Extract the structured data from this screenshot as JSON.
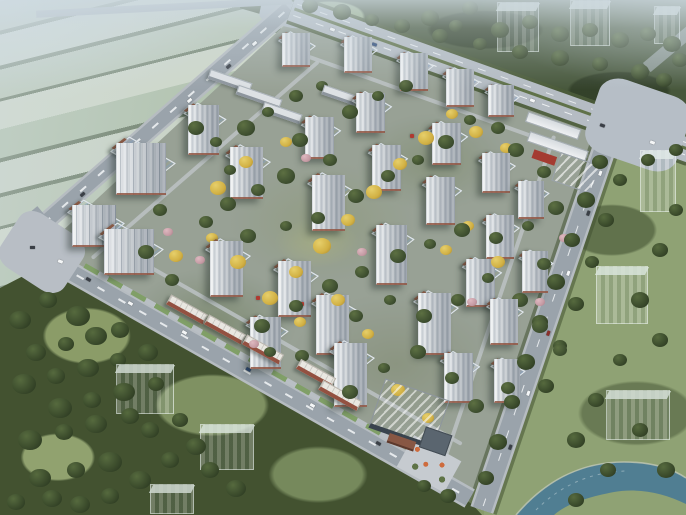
{
  "scene": {
    "type": "aerial-architectural-rendering",
    "subject": "residential-masterplan-birdseye",
    "width": 686,
    "height": 515
  },
  "palette": {
    "farm_light": "#c6d0bd",
    "farm_mid": "#b2c2a9",
    "hedge": "#5d7053",
    "forest": "#46573a",
    "park": "#42522f",
    "lawn": "#8a9c66",
    "east_lawn": "#8ea272",
    "asphalt": "#9aa3ab",
    "arterial": "#b5bcc3",
    "lane_line": "#eef1f3",
    "median_green": "#5f7247",
    "plaza": "#b8bec5",
    "site_ground": "#98a195",
    "tower_roof_navy": "#2c3e54",
    "tower_facade": "#eceff1",
    "tower_shade": "#aab3bc",
    "roof_trim_brown": "#8a5a45",
    "brick_retail": "#96503f",
    "retail_roof": "#e9e7e1",
    "school_white": "#eef0f2",
    "school_red": "#a83a2f",
    "water": "#4e7e93",
    "ghost_building": "rgba(190,206,201,0.55)",
    "gold_tree": "#d4b13e",
    "pink_tree": "#c79aa4",
    "accent_red": "#b5382e",
    "haze": "#cfdbe3"
  },
  "buildings": {
    "towers": [
      [
        282,
        36,
        30,
        34
      ],
      [
        344,
        40,
        30,
        36
      ],
      [
        400,
        56,
        30,
        38
      ],
      [
        446,
        72,
        30,
        38
      ],
      [
        488,
        88,
        28,
        32
      ],
      [
        305,
        120,
        32,
        42
      ],
      [
        356,
        96,
        32,
        40
      ],
      [
        432,
        126,
        32,
        42
      ],
      [
        482,
        156,
        30,
        40
      ],
      [
        518,
        184,
        28,
        38
      ],
      [
        188,
        108,
        34,
        50
      ],
      [
        230,
        150,
        36,
        52
      ],
      [
        312,
        178,
        36,
        56
      ],
      [
        372,
        148,
        32,
        46
      ],
      [
        426,
        180,
        32,
        48
      ],
      [
        486,
        218,
        30,
        44
      ],
      [
        72,
        208,
        48,
        42
      ],
      [
        116,
        146,
        54,
        52
      ],
      [
        104,
        232,
        54,
        46
      ],
      [
        210,
        244,
        36,
        56
      ],
      [
        278,
        264,
        36,
        56
      ],
      [
        376,
        228,
        34,
        60
      ],
      [
        466,
        262,
        32,
        48
      ],
      [
        522,
        254,
        28,
        42
      ],
      [
        250,
        320,
        34,
        52
      ],
      [
        316,
        298,
        36,
        60
      ],
      [
        418,
        296,
        36,
        62
      ],
      [
        490,
        302,
        30,
        46
      ],
      [
        494,
        362,
        28,
        44
      ],
      [
        334,
        346,
        36,
        64
      ],
      [
        444,
        356,
        32,
        50
      ]
    ],
    "ghosts": [
      [
        497,
        2,
        42,
        50
      ],
      [
        570,
        0,
        40,
        46
      ],
      [
        654,
        6,
        26,
        38
      ],
      [
        640,
        150,
        36,
        62
      ],
      [
        596,
        266,
        52,
        58
      ],
      [
        606,
        390,
        64,
        50
      ],
      [
        116,
        364,
        58,
        50
      ],
      [
        200,
        424,
        54,
        46
      ],
      [
        150,
        484,
        44,
        30
      ]
    ],
    "retail_blocks": [
      [
        166,
        304,
        42
      ],
      [
        204,
        324,
        42
      ],
      [
        242,
        344,
        42
      ],
      [
        296,
        368,
        40
      ],
      [
        318,
        390,
        44
      ]
    ],
    "low_blocks": [
      [
        208,
        76,
        44
      ],
      [
        236,
        92,
        46
      ],
      [
        322,
        90,
        34
      ],
      [
        262,
        108,
        40
      ]
    ]
  },
  "vegetation": {
    "site_green": [
      [
        196,
        128,
        8
      ],
      [
        216,
        142,
        6
      ],
      [
        246,
        128,
        9
      ],
      [
        268,
        112,
        6
      ],
      [
        296,
        96,
        7
      ],
      [
        322,
        86,
        6
      ],
      [
        350,
        112,
        8
      ],
      [
        378,
        96,
        6
      ],
      [
        406,
        86,
        7
      ],
      [
        300,
        140,
        8
      ],
      [
        330,
        160,
        7
      ],
      [
        286,
        176,
        9
      ],
      [
        258,
        190,
        7
      ],
      [
        228,
        204,
        8
      ],
      [
        206,
        222,
        7
      ],
      [
        248,
        236,
        8
      ],
      [
        286,
        226,
        6
      ],
      [
        318,
        218,
        7
      ],
      [
        356,
        196,
        8
      ],
      [
        388,
        176,
        7
      ],
      [
        418,
        160,
        6
      ],
      [
        446,
        142,
        8
      ],
      [
        470,
        120,
        6
      ],
      [
        498,
        128,
        7
      ],
      [
        516,
        150,
        8
      ],
      [
        544,
        172,
        7
      ],
      [
        556,
        208,
        8
      ],
      [
        528,
        226,
        6
      ],
      [
        496,
        238,
        7
      ],
      [
        462,
        230,
        8
      ],
      [
        430,
        244,
        6
      ],
      [
        398,
        256,
        8
      ],
      [
        362,
        272,
        7
      ],
      [
        330,
        286,
        8
      ],
      [
        296,
        306,
        7
      ],
      [
        262,
        326,
        8
      ],
      [
        356,
        316,
        7
      ],
      [
        390,
        300,
        6
      ],
      [
        424,
        316,
        8
      ],
      [
        458,
        300,
        7
      ],
      [
        488,
        278,
        6
      ],
      [
        520,
        300,
        8
      ],
      [
        544,
        264,
        7
      ],
      [
        418,
        352,
        8
      ],
      [
        452,
        378,
        7
      ],
      [
        384,
        368,
        6
      ],
      [
        350,
        392,
        8
      ],
      [
        302,
        356,
        7
      ],
      [
        270,
        352,
        6
      ],
      [
        476,
        406,
        8
      ],
      [
        508,
        388,
        7
      ],
      [
        540,
        326,
        8
      ],
      [
        560,
        350,
        7
      ],
      [
        230,
        170,
        6
      ],
      [
        160,
        210,
        7
      ],
      [
        146,
        252,
        8
      ],
      [
        172,
        280,
        7
      ]
    ],
    "gold": [
      [
        270,
        298,
        8
      ],
      [
        296,
        272,
        7
      ],
      [
        322,
        246,
        9
      ],
      [
        348,
        220,
        7
      ],
      [
        374,
        192,
        8
      ],
      [
        400,
        164,
        7
      ],
      [
        426,
        138,
        8
      ],
      [
        452,
        114,
        6
      ],
      [
        476,
        132,
        7
      ],
      [
        300,
        322,
        6
      ],
      [
        238,
        262,
        8
      ],
      [
        212,
        238,
        6
      ],
      [
        246,
        162,
        7
      ],
      [
        218,
        188,
        8
      ],
      [
        468,
        226,
        6
      ],
      [
        498,
        262,
        7
      ],
      [
        446,
        250,
        6
      ],
      [
        506,
        148,
        6
      ],
      [
        286,
        142,
        6
      ],
      [
        338,
        300,
        7
      ],
      [
        368,
        334,
        6
      ],
      [
        398,
        390,
        7
      ],
      [
        428,
        418,
        6
      ],
      [
        176,
        256,
        7
      ]
    ],
    "pink": [
      [
        168,
        232,
        5
      ],
      [
        306,
        158,
        5
      ],
      [
        362,
        252,
        5
      ],
      [
        472,
        302,
        5
      ],
      [
        540,
        302,
        5
      ],
      [
        254,
        344,
        5
      ],
      [
        200,
        260,
        5
      ],
      [
        564,
        238,
        5
      ]
    ],
    "park": [
      [
        20,
        320,
        11
      ],
      [
        48,
        300,
        9
      ],
      [
        78,
        316,
        12
      ],
      [
        36,
        352,
        10
      ],
      [
        66,
        344,
        8
      ],
      [
        96,
        336,
        11
      ],
      [
        120,
        330,
        9
      ],
      [
        24,
        384,
        12
      ],
      [
        56,
        376,
        9
      ],
      [
        88,
        368,
        11
      ],
      [
        118,
        360,
        8
      ],
      [
        148,
        352,
        10
      ],
      [
        60,
        408,
        12
      ],
      [
        92,
        400,
        9
      ],
      [
        124,
        392,
        11
      ],
      [
        156,
        384,
        8
      ],
      [
        30,
        440,
        12
      ],
      [
        64,
        432,
        9
      ],
      [
        96,
        424,
        11
      ],
      [
        130,
        416,
        9
      ],
      [
        40,
        478,
        11
      ],
      [
        76,
        470,
        9
      ],
      [
        110,
        462,
        12
      ],
      [
        16,
        502,
        9
      ],
      [
        52,
        498,
        10
      ],
      [
        150,
        430,
        9
      ],
      [
        180,
        420,
        8
      ],
      [
        196,
        446,
        10
      ],
      [
        170,
        460,
        9
      ],
      [
        140,
        480,
        11
      ],
      [
        110,
        496,
        9
      ],
      [
        80,
        504,
        10
      ],
      [
        210,
        470,
        9
      ],
      [
        236,
        488,
        10
      ]
    ],
    "forest_north": [
      [
        310,
        6,
        8
      ],
      [
        342,
        12,
        9
      ],
      [
        372,
        20,
        7
      ],
      [
        402,
        26,
        8
      ],
      [
        430,
        18,
        9
      ],
      [
        456,
        26,
        7
      ],
      [
        470,
        8,
        8
      ],
      [
        500,
        30,
        9
      ],
      [
        530,
        22,
        8
      ],
      [
        560,
        34,
        9
      ],
      [
        590,
        30,
        8
      ],
      [
        620,
        40,
        9
      ],
      [
        648,
        34,
        8
      ],
      [
        672,
        44,
        9
      ],
      [
        520,
        52,
        8
      ],
      [
        560,
        58,
        9
      ],
      [
        600,
        64,
        8
      ],
      [
        640,
        72,
        9
      ],
      [
        664,
        80,
        8
      ],
      [
        680,
        60,
        8
      ],
      [
        480,
        44,
        7
      ],
      [
        440,
        36,
        8
      ]
    ],
    "east": [
      [
        600,
        162,
        8
      ],
      [
        586,
        200,
        9
      ],
      [
        572,
        240,
        8
      ],
      [
        556,
        282,
        9
      ],
      [
        540,
        322,
        8
      ],
      [
        526,
        362,
        9
      ],
      [
        512,
        402,
        8
      ],
      [
        498,
        442,
        9
      ],
      [
        486,
        478,
        8
      ],
      [
        620,
        180,
        7
      ],
      [
        606,
        220,
        8
      ],
      [
        592,
        262,
        7
      ],
      [
        576,
        304,
        8
      ],
      [
        560,
        346,
        7
      ],
      [
        546,
        386,
        8
      ],
      [
        640,
        300,
        9
      ],
      [
        660,
        340,
        8
      ],
      [
        620,
        360,
        7
      ],
      [
        596,
        400,
        8
      ],
      [
        576,
        440,
        9
      ],
      [
        640,
        430,
        8
      ],
      [
        666,
        470,
        9
      ],
      [
        608,
        470,
        8
      ],
      [
        576,
        500,
        8
      ],
      [
        660,
        250,
        8
      ],
      [
        676,
        210,
        7
      ],
      [
        648,
        160,
        7
      ],
      [
        676,
        150,
        7
      ],
      [
        448,
        496,
        8
      ],
      [
        424,
        486,
        7
      ]
    ]
  },
  "traffic": {
    "car_colors": [
      "#f4f6f7",
      "#3a3f46",
      "#8e2f2a",
      "#2c4a7c"
    ],
    "cars": [
      [
        252,
        42,
        -41,
        0
      ],
      [
        226,
        65,
        -41,
        1
      ],
      [
        187,
        99,
        -41,
        0
      ],
      [
        120,
        158,
        -41,
        2
      ],
      [
        80,
        193,
        -41,
        1
      ],
      [
        330,
        28,
        19.6,
        0
      ],
      [
        372,
        43,
        19.6,
        3
      ],
      [
        420,
        60,
        19.6,
        0
      ],
      [
        468,
        77,
        19.6,
        1
      ],
      [
        530,
        99,
        19.6,
        0
      ],
      [
        600,
        124,
        19.6,
        1
      ],
      [
        650,
        141,
        19.6,
        0
      ],
      [
        598,
        172,
        109,
        0
      ],
      [
        586,
        212,
        109,
        1
      ],
      [
        566,
        272,
        109,
        0
      ],
      [
        546,
        332,
        109,
        2
      ],
      [
        526,
        392,
        109,
        0
      ],
      [
        508,
        446,
        109,
        1
      ],
      [
        86,
        278,
        29.6,
        1
      ],
      [
        128,
        302,
        29.6,
        0
      ],
      [
        182,
        331,
        29.6,
        0
      ],
      [
        246,
        368,
        29.6,
        3
      ],
      [
        310,
        404,
        29.6,
        0
      ],
      [
        376,
        442,
        29.6,
        1
      ],
      [
        428,
        472,
        29.6,
        1
      ],
      [
        30,
        246,
        0,
        1
      ],
      [
        58,
        260,
        20,
        0
      ]
    ]
  },
  "accents": {
    "red_features": [
      [
        322,
        240
      ],
      [
        410,
        134
      ],
      [
        300,
        302
      ],
      [
        256,
        296
      ]
    ]
  }
}
